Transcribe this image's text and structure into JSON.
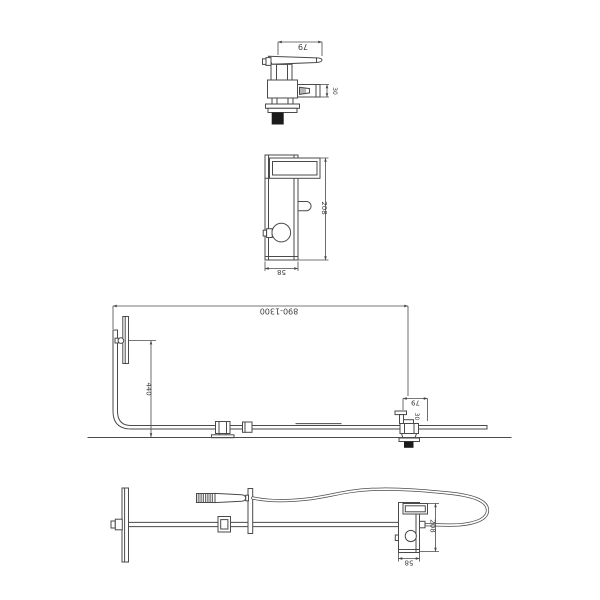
{
  "colors": {
    "background": "#ffffff",
    "line": "#4a4a4a",
    "dark_fill": "#1b1b1b"
  },
  "views": {
    "valve_side": {
      "dim_width": "79",
      "dim_spout": "30"
    },
    "unit_front": {
      "dim_height": "208",
      "dim_width": "58"
    },
    "installation": {
      "dim_rail_span": "890-1300",
      "dim_head_height": "440",
      "dim_valve_width": "79",
      "dim_valve_spout": "30"
    },
    "layout_flat": {
      "dim_body_height": "208",
      "dim_body_width": "58"
    }
  }
}
